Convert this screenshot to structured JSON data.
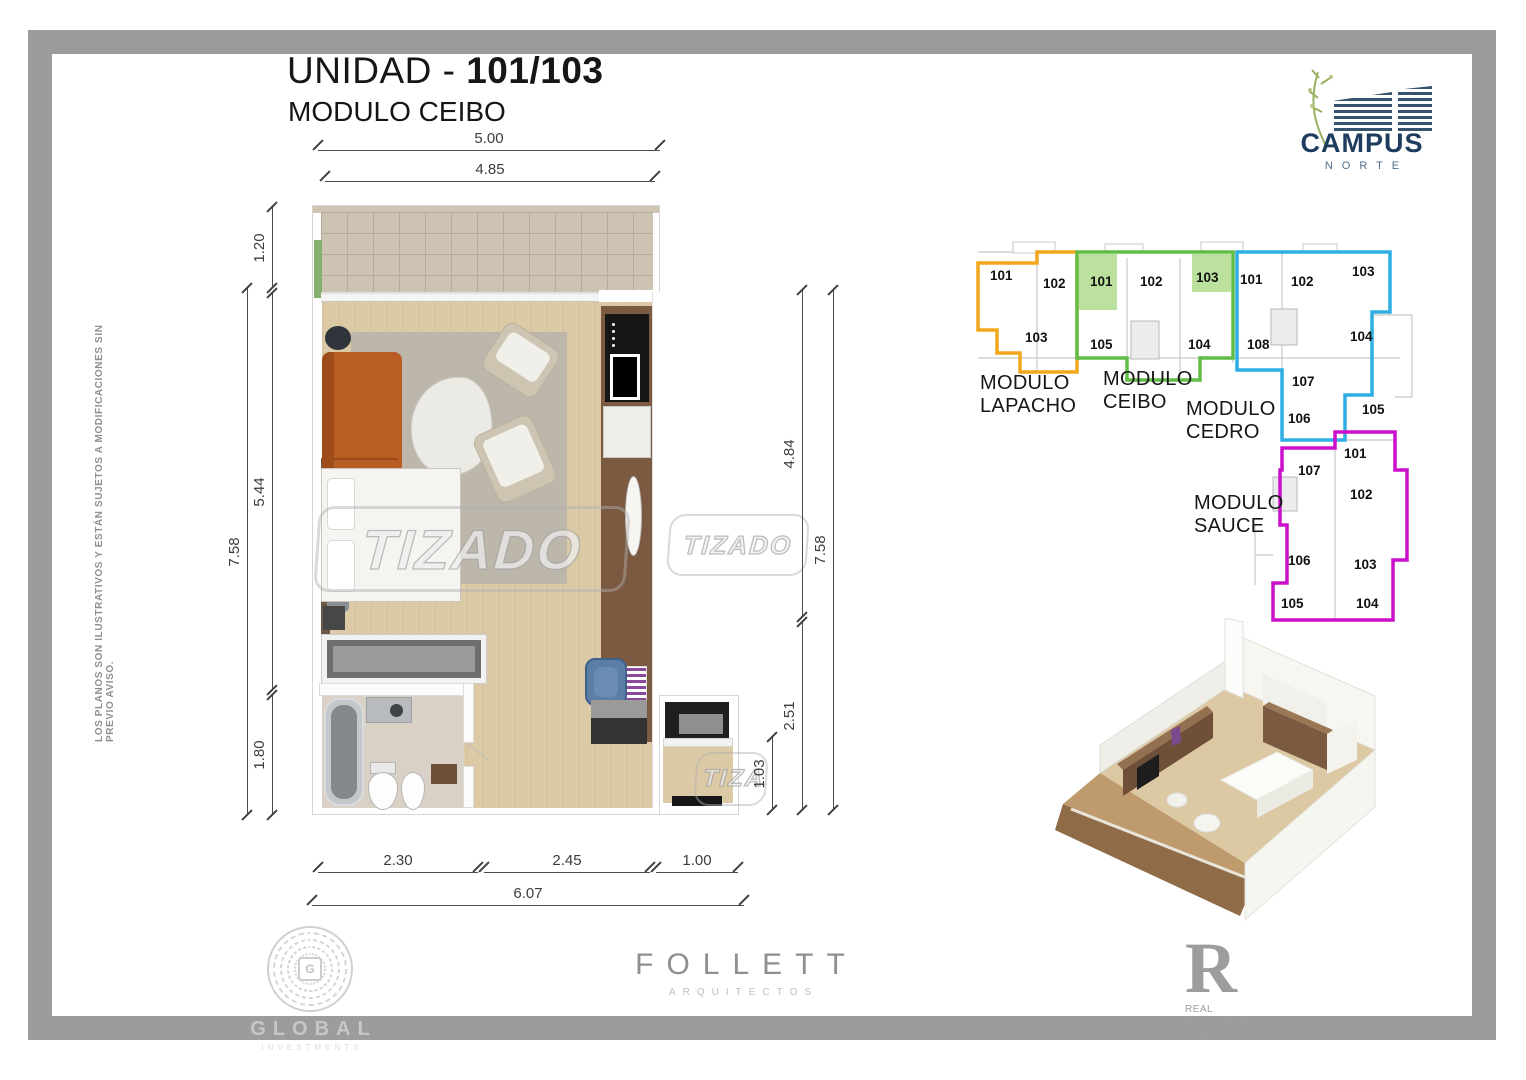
{
  "page": {
    "title_prefix": "UNIDAD - ",
    "title_number": "101/103",
    "subtitle": "MODULO CEIBO"
  },
  "disclaimer": "LOS PLANOS SON ILUSTRATIVOS Y ESTÁN SUJETOS A MODIFICACIONES SIN PREVIO AVISO.",
  "watermark": {
    "text": "TIZADO"
  },
  "floorplan": {
    "dims": {
      "top_outer": "5.00",
      "top_inner": "4.85",
      "left_balcony": "1.20",
      "left_living": "5.44",
      "left_bath": "1.80",
      "left_total": "7.58",
      "right_upper": "4.84",
      "right_lower": "2.51",
      "right_entry": "1.03",
      "right_total": "7.58",
      "bottom_bath": "2.30",
      "bottom_mid": "2.45",
      "bottom_entry": "1.00",
      "bottom_total": "6.07"
    }
  },
  "keyplan": {
    "modules": [
      {
        "line1": "MODULO",
        "line2": "LAPACHO",
        "color": "#F2A71B",
        "units": [
          {
            "n": "101"
          },
          {
            "n": "102"
          },
          {
            "n": "103"
          }
        ]
      },
      {
        "line1": "MODULO",
        "line2": "CEIBO",
        "color": "#62BD47",
        "fill": "#BCE09E",
        "units": [
          {
            "n": "101"
          },
          {
            "n": "102"
          },
          {
            "n": "103"
          },
          {
            "n": "105"
          },
          {
            "n": "104"
          }
        ]
      },
      {
        "line1": "MODULO",
        "line2": "CEDRO",
        "color": "#2FAEE3",
        "units": [
          {
            "n": "101"
          },
          {
            "n": "102"
          },
          {
            "n": "103"
          },
          {
            "n": "108"
          },
          {
            "n": "104"
          },
          {
            "n": "107"
          },
          {
            "n": "106"
          },
          {
            "n": "105"
          }
        ]
      },
      {
        "line1": "MODULO",
        "line2": "SAUCE",
        "color": "#CC0FCC",
        "units": [
          {
            "n": "101"
          },
          {
            "n": "107"
          },
          {
            "n": "102"
          },
          {
            "n": "106"
          },
          {
            "n": "103"
          },
          {
            "n": "105"
          },
          {
            "n": "104"
          }
        ]
      }
    ]
  },
  "logos": {
    "campus": {
      "name": "CAMPUS",
      "subname": "NORTE"
    },
    "global": {
      "monogram": "G",
      "name": "GLOBAL",
      "subname": "INVESTMENTS"
    },
    "follett": {
      "name": "FOLLETT",
      "subname": "ARQUITECTOS"
    },
    "rit": {
      "initial": "R",
      "line1": "REAL",
      "line2": "INVESTMENT",
      "line3": "TRUST"
    }
  }
}
